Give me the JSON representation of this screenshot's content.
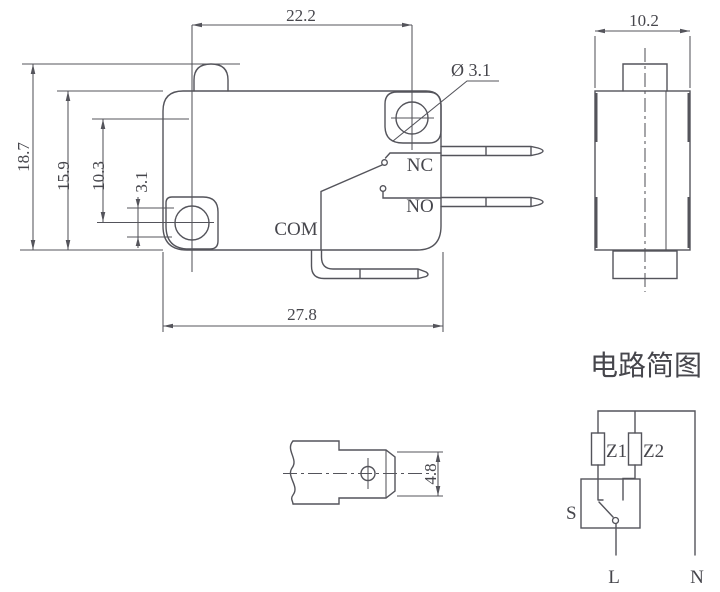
{
  "front_view": {
    "dim_hole_spacing_h": "22.2",
    "dim_total_height": "18.7",
    "dim_body_height": "15.9",
    "dim_hole_spacing_v": "10.3",
    "dim_hole_size": "3.1",
    "dim_body_width": "27.8",
    "hole_diameter_label": "Ø 3.1",
    "terminal_nc": "NC",
    "terminal_no": "NO",
    "terminal_com": "COM"
  },
  "side_view": {
    "dim_body_depth": "10.2"
  },
  "terminal_detail": {
    "dim_terminal_width": "4.8"
  },
  "circuit_diagram": {
    "title": "电路简图",
    "impedance_1": "Z1",
    "impedance_2": "Z2",
    "switch_label": "S",
    "live_label": "L",
    "neutral_label": "N"
  },
  "colors": {
    "line": "#54545b",
    "text": "#46464c",
    "background": "#ffffff"
  }
}
